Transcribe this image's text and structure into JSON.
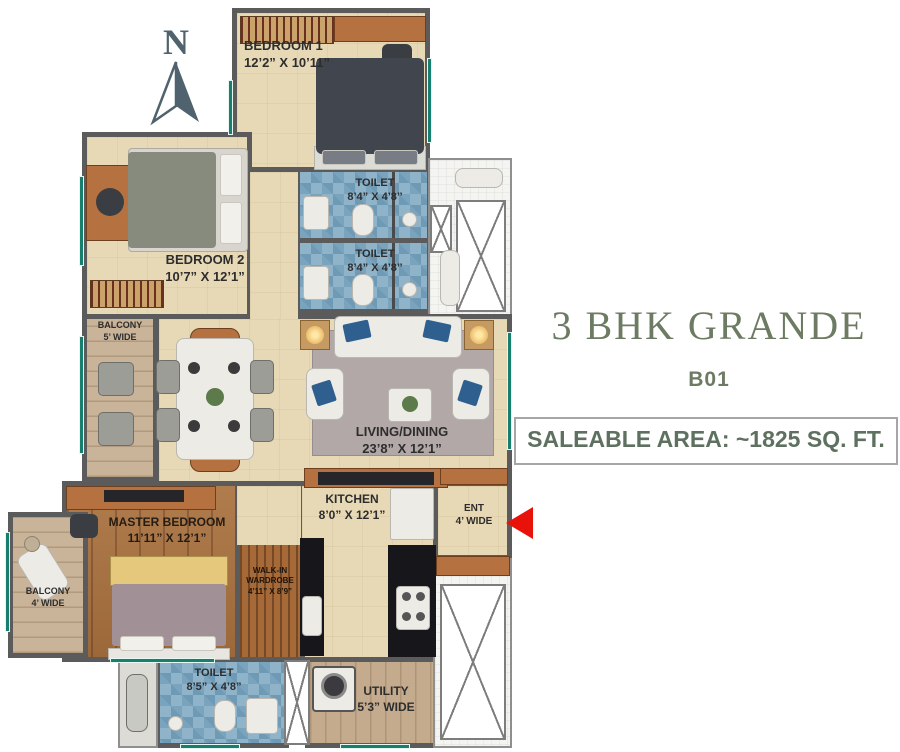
{
  "title": {
    "name": "3 BHK GRANDE",
    "unit": "B01",
    "saleable": "SALEABLE AREA: ~1825 SQ. FT."
  },
  "compass": {
    "label": "N"
  },
  "entry": {
    "label": "ENT",
    "width": "4’ WIDE"
  },
  "rooms": {
    "bedroom1": {
      "label": "BEDROOM 1",
      "dims": "12’2” X 10’11”"
    },
    "toilet1": {
      "label": "TOILET",
      "dims": "8’4” X 4’8’’"
    },
    "toilet2": {
      "label": "TOILET",
      "dims": "8’4” X 4’8’’"
    },
    "bedroom2": {
      "label": "BEDROOM 2",
      "dims": "10’7” X 12’1”"
    },
    "balcony5": {
      "label": "BALCONY",
      "dims": "5’ WIDE"
    },
    "living": {
      "label": "LIVING/DINING",
      "dims": "23’8” X 12’1”"
    },
    "kitchen": {
      "label": "KITCHEN",
      "dims": "8’0” X 12’1”"
    },
    "master": {
      "label": "MASTER BEDROOM",
      "dims": "11’11” X 12’1”"
    },
    "wardrobe": {
      "label": "WALK-IN WARDROBE",
      "dims": "4’11” X 8’9”"
    },
    "balcony4": {
      "label": "BALCONY",
      "dims": "4’ WIDE"
    },
    "toilet3": {
      "label": "TOILET",
      "dims": "8’5” X 4’8”"
    },
    "utility": {
      "label": "UTILITY",
      "dims": "5’3” WIDE"
    }
  },
  "colors": {
    "accent_green": "#6d7b62",
    "wall_gray": "#5b5b5b",
    "entry_arrow_red": "#e8120b",
    "window_teal": "#177f6d",
    "floor_beige": "#e8d9b6",
    "toilet_blue": "#8fb3c9",
    "wood_brown": "#a9713f"
  }
}
